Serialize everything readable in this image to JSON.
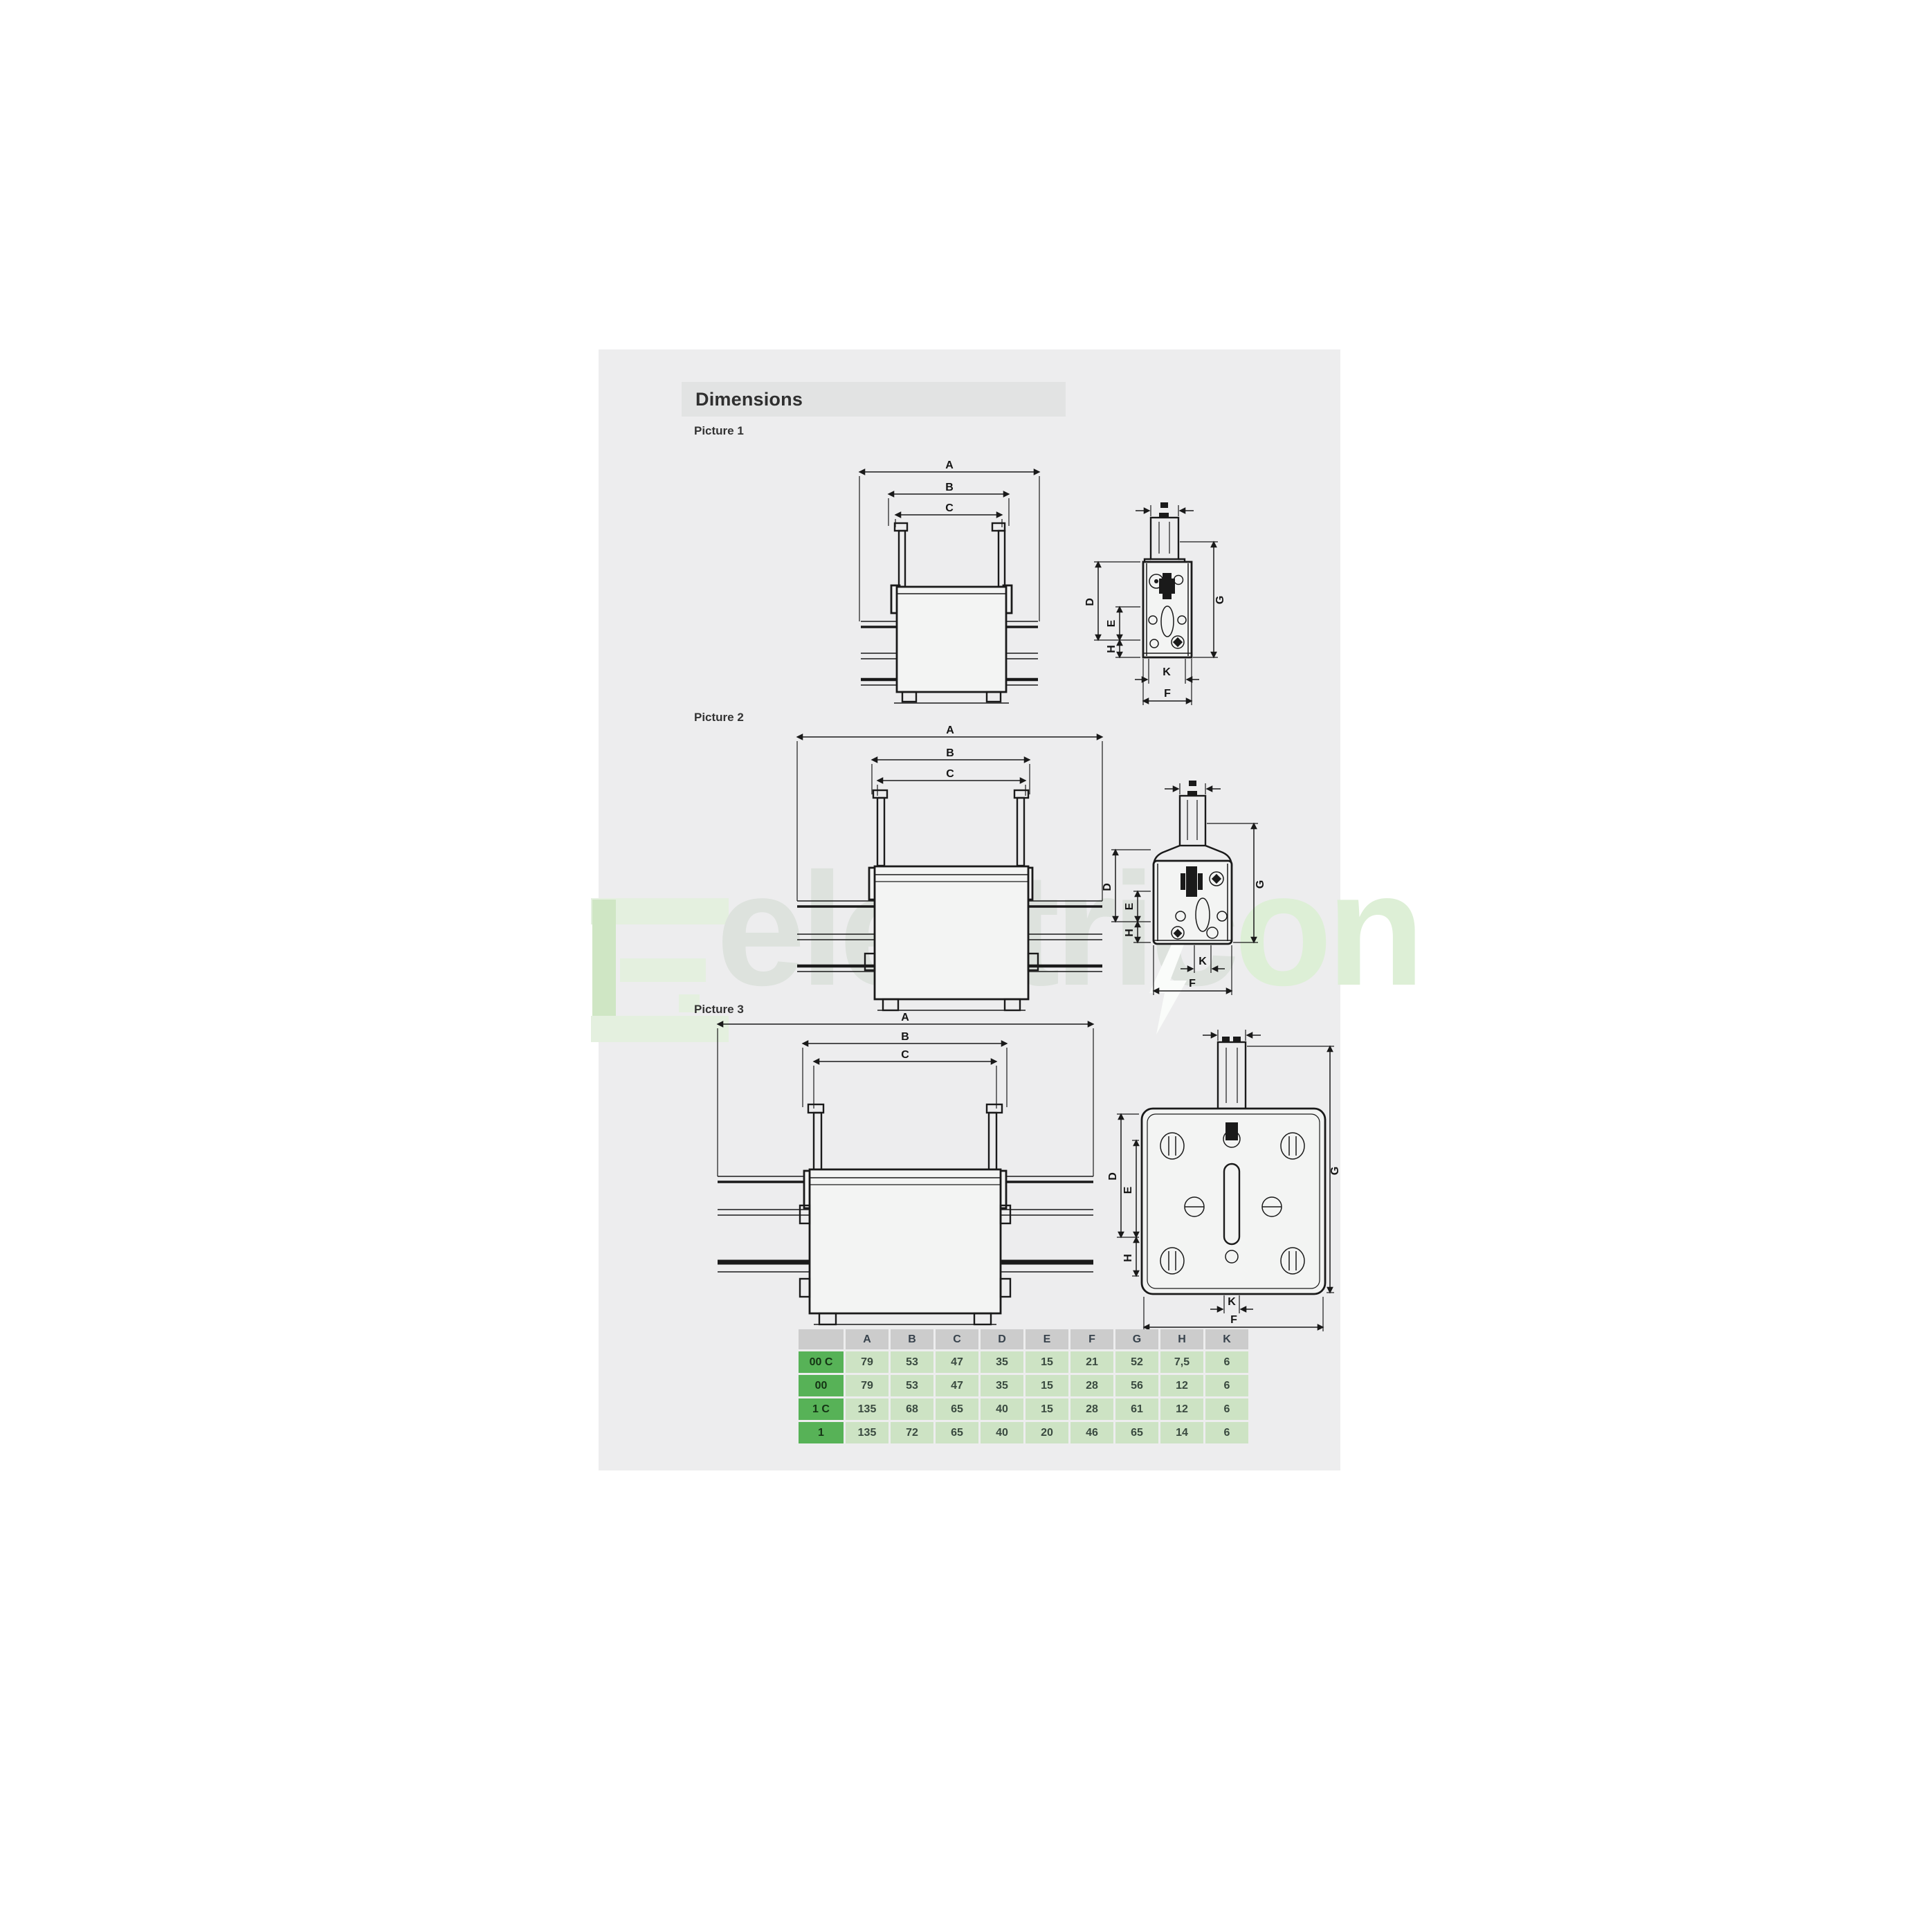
{
  "header": {
    "title": "Dimensions"
  },
  "pictures": [
    {
      "label": "Picture 1"
    },
    {
      "label": "Picture 2"
    },
    {
      "label": "Picture 3"
    }
  ],
  "dim_labels": {
    "A": "A",
    "B": "B",
    "C": "C",
    "D": "D",
    "E": "E",
    "F": "F",
    "G": "G",
    "H": "H",
    "K": "K"
  },
  "watermark": {
    "text_main": "electric",
    "text_accent": "on"
  },
  "table": {
    "col_headers": [
      "",
      "A",
      "B",
      "C",
      "D",
      "E",
      "F",
      "G",
      "H",
      "K"
    ],
    "rows": [
      {
        "name": "00 C",
        "values": [
          "79",
          "53",
          "47",
          "35",
          "15",
          "21",
          "52",
          "7,5",
          "6"
        ]
      },
      {
        "name": "00",
        "values": [
          "79",
          "53",
          "47",
          "35",
          "15",
          "28",
          "56",
          "12",
          "6"
        ]
      },
      {
        "name": "1 C",
        "values": [
          "135",
          "68",
          "65",
          "40",
          "15",
          "28",
          "61",
          "12",
          "6"
        ]
      },
      {
        "name": "1",
        "values": [
          "135",
          "72",
          "65",
          "40",
          "20",
          "46",
          "65",
          "14",
          "6"
        ]
      }
    ]
  },
  "colors": {
    "page_bg": "#ededee",
    "title_bar_bg": "#e2e3e3",
    "table_header_bg": "#cccccc",
    "table_row_header_bg": "#57b257",
    "table_cell_bg": "#cde3c4",
    "drawing_line": "#1a1a1a",
    "watermark_green": "#ddefd6"
  }
}
